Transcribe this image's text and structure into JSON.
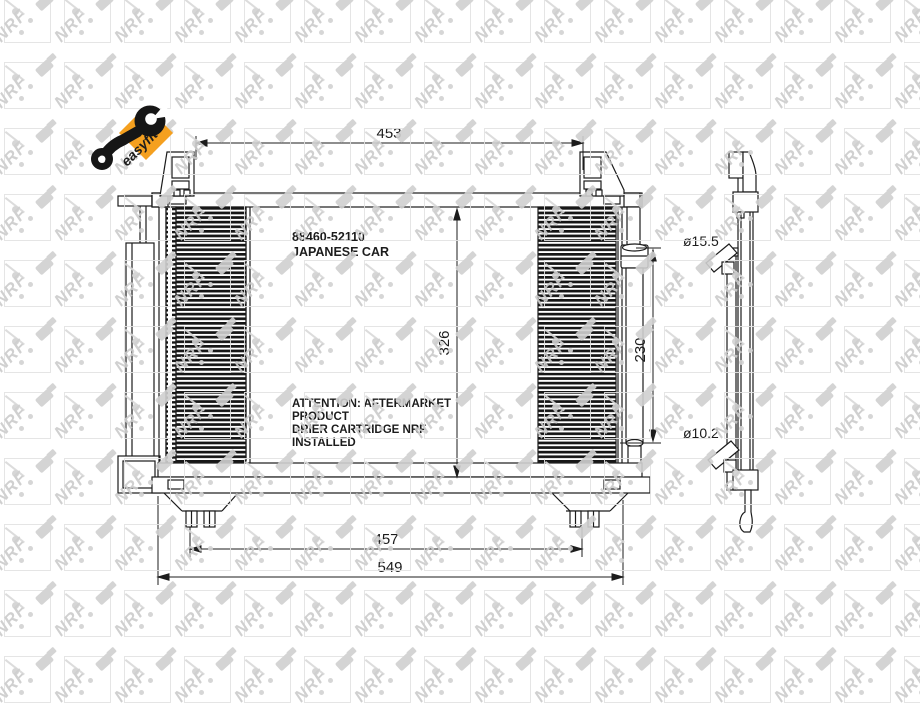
{
  "badge": {
    "label": "easyfit",
    "color": "#F5A01F"
  },
  "watermark": {
    "logo": "NRF"
  },
  "drawing": {
    "part_number": "88460-52110",
    "vehicle": "JAPANESE CAR",
    "note_lines": [
      "ATTENTION: AFTERMARKET",
      "PRODUCT",
      "DRIER CARTRIDGE NRF",
      "INSTALLED"
    ],
    "dims": {
      "width_top": "453",
      "height_core": "326",
      "height_drier": "230",
      "width_mount": "457",
      "width_overall": "549",
      "dia_inlet": "ø15.5",
      "dia_outlet": "ø10.2"
    }
  }
}
